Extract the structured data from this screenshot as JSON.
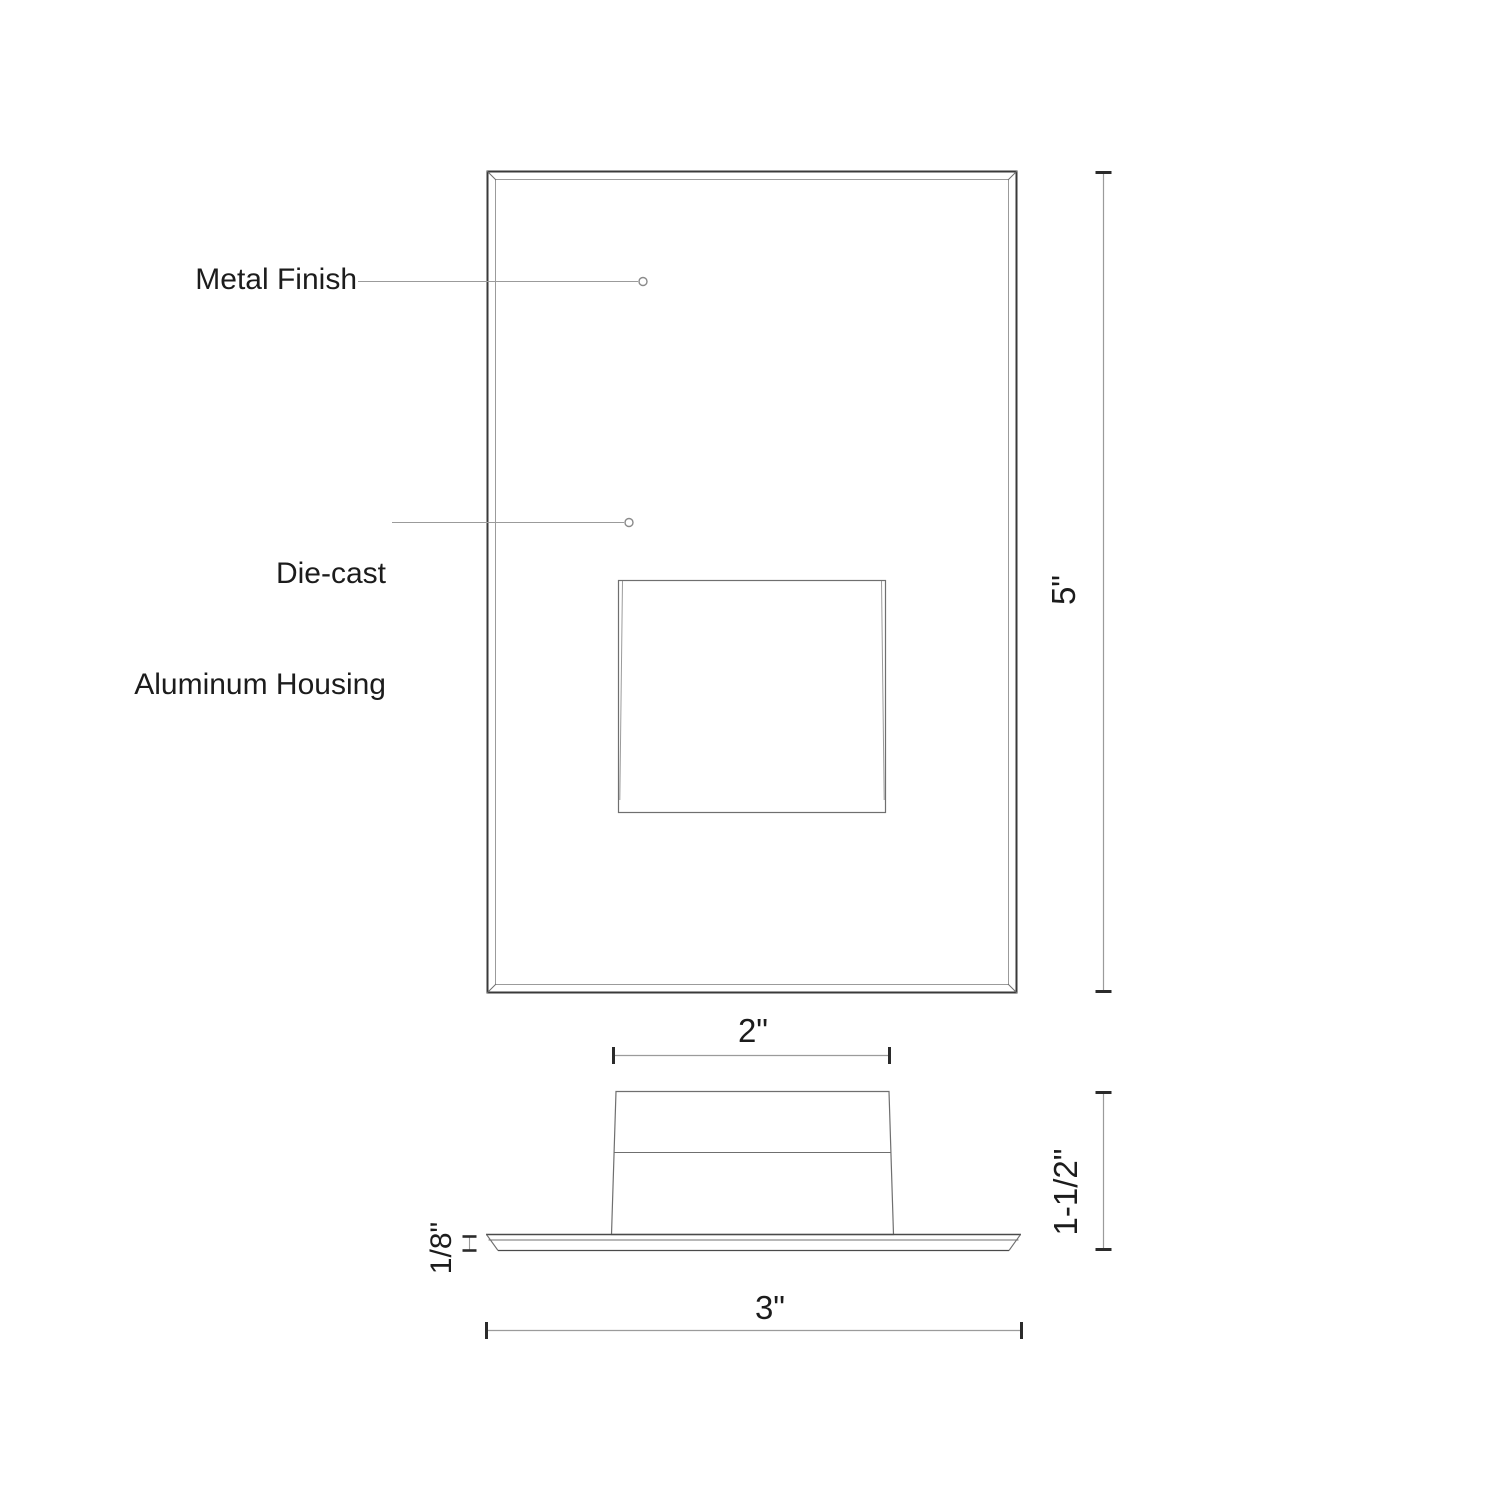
{
  "annotations": {
    "metal_finish": "Metal Finish",
    "die_cast_line1": "Die-cast",
    "die_cast_line2": "Aluminum Housing"
  },
  "dimensions": {
    "front_height": "5\"",
    "housing_width": "2\"",
    "side_height": "1-1/2\"",
    "plate_thickness": "1/8\"",
    "plate_width": "3\""
  },
  "colors": {
    "background": "#ffffff",
    "outline_dark": "#3a3a3a",
    "outline_mid": "#6f6f6f",
    "dim_line": "#9b9b9b",
    "tick": "#2b2b2b",
    "text": "#1c1c1c"
  }
}
